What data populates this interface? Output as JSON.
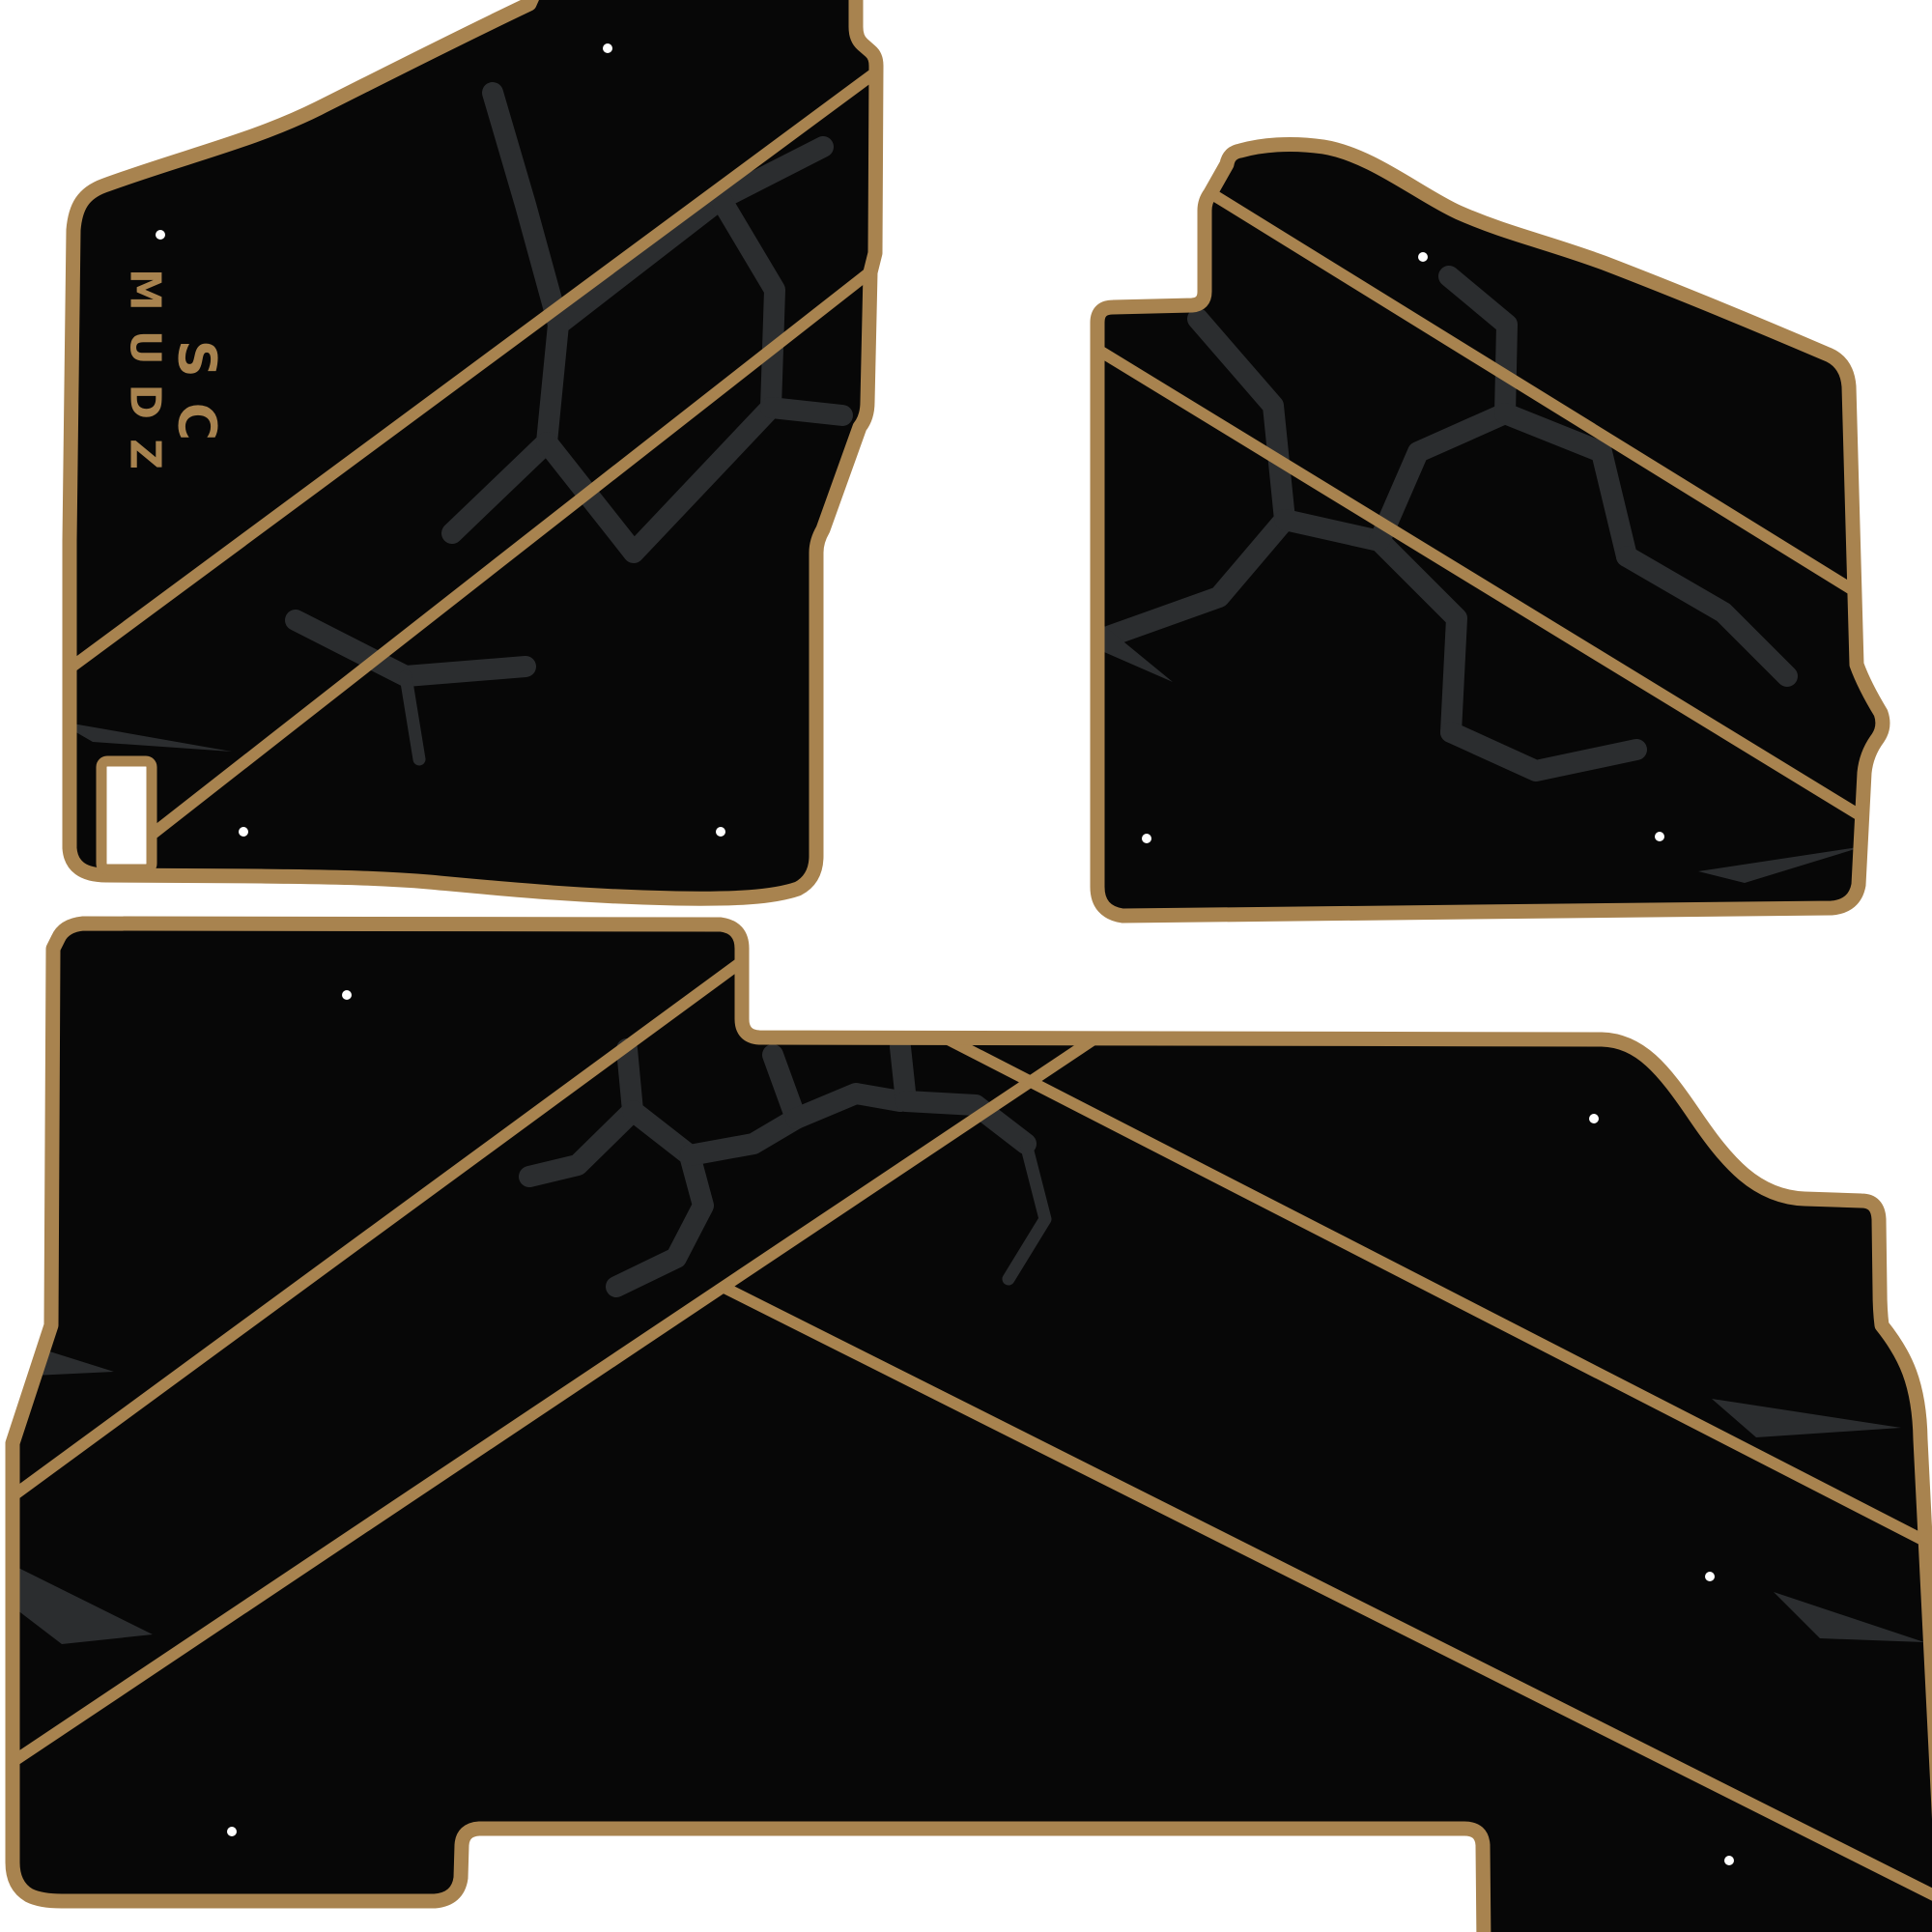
{
  "page": {
    "title": "Custom floor mat set product image",
    "background": "#ffffff"
  },
  "colors": {
    "background": "#ffffff",
    "mat": "#070707",
    "trim": "#a8834f",
    "crack": "#2b2d2f",
    "hole": "#ffffff",
    "logo": "#a8834f"
  },
  "logo": {
    "line1": "SC",
    "line2": "MUDZ"
  },
  "mats": [
    {
      "id": "front-left",
      "name": "Front left (driver) mat with SC MUDZ logo"
    },
    {
      "id": "front-right",
      "name": "Front right (passenger) mat"
    },
    {
      "id": "rear",
      "name": "Rear bench mat with center notch"
    }
  ]
}
